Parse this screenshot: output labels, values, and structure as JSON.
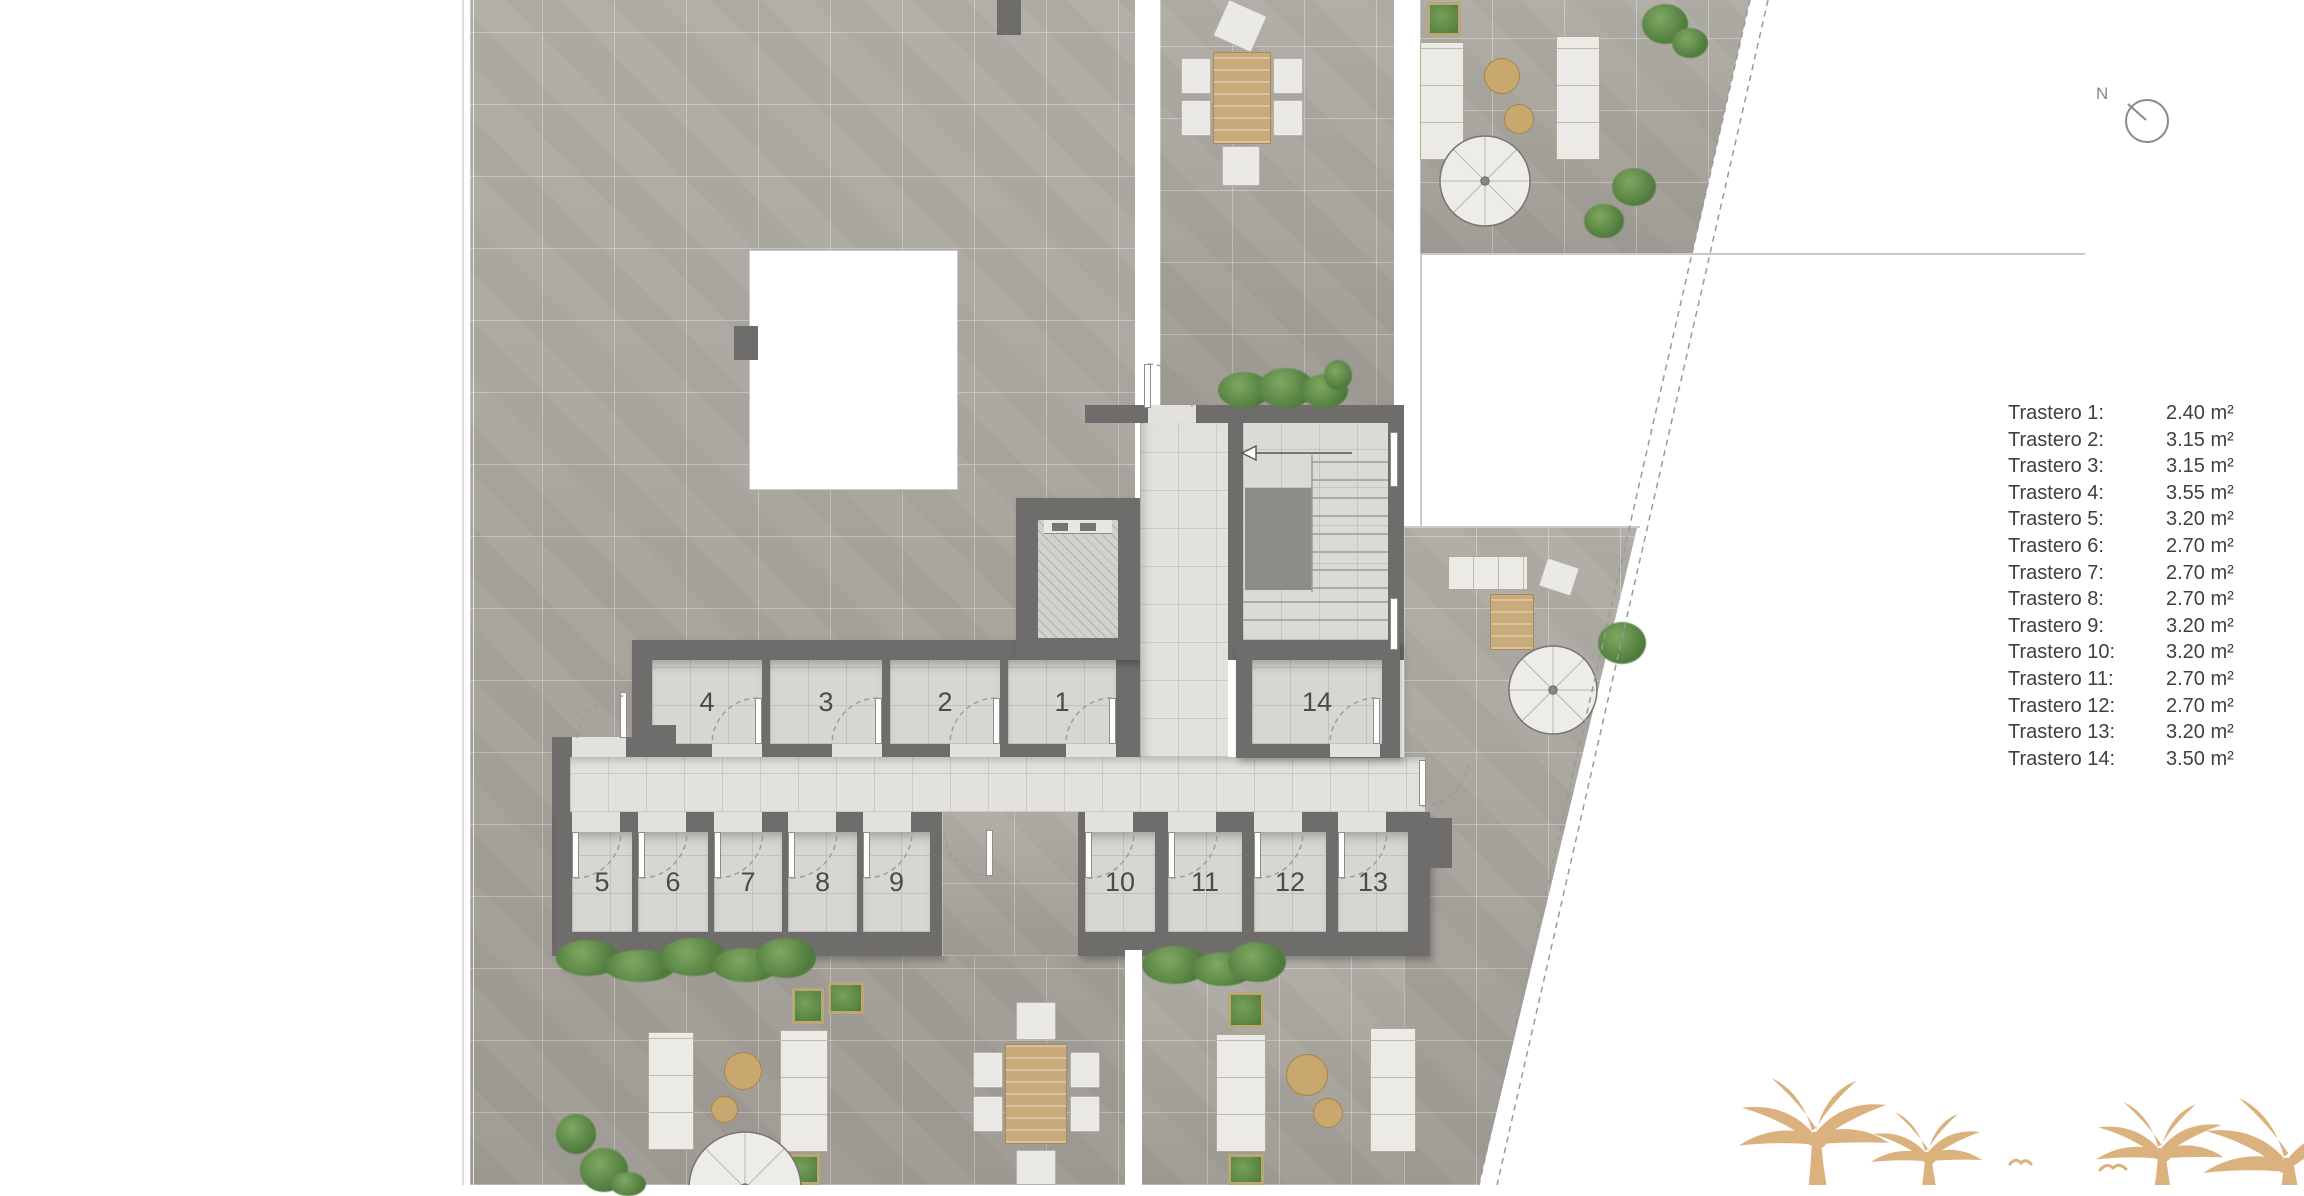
{
  "compass": {
    "label": "N"
  },
  "rooms": {
    "r1": "1",
    "r2": "2",
    "r3": "3",
    "r4": "4",
    "r5": "5",
    "r6": "6",
    "r7": "7",
    "r8": "8",
    "r9": "9",
    "r10": "10",
    "r11": "11",
    "r12": "12",
    "r13": "13",
    "r14": "14"
  },
  "legend": {
    "items": [
      {
        "label": "Trastero 1:",
        "value": "2.40 m²"
      },
      {
        "label": "Trastero 2:",
        "value": "3.15 m²"
      },
      {
        "label": "Trastero 3:",
        "value": "3.15 m²"
      },
      {
        "label": "Trastero 4:",
        "value": "3.55 m²"
      },
      {
        "label": "Trastero 5:",
        "value": "3.20 m²"
      },
      {
        "label": "Trastero 6:",
        "value": "2.70 m²"
      },
      {
        "label": "Trastero 7:",
        "value": "2.70 m²"
      },
      {
        "label": "Trastero 8:",
        "value": "2.70 m²"
      },
      {
        "label": "Trastero 9:",
        "value": "3.20 m²"
      },
      {
        "label": "Trastero 10:",
        "value": "3.20 m²"
      },
      {
        "label": "Trastero 11:",
        "value": "2.70 m²"
      },
      {
        "label": "Trastero 12:",
        "value": "2.70 m²"
      },
      {
        "label": "Trastero 13:",
        "value": "3.20 m²"
      },
      {
        "label": "Trastero 14:",
        "value": "3.50 m²"
      }
    ]
  },
  "colors": {
    "terrace": "#a9a59e",
    "wall": "#6e6d6b",
    "interior_floor": "#e2e1dd",
    "wood": "#c9aa7b",
    "greenery": "#4e7a3c",
    "palm_watermark": "#dbb27e"
  }
}
